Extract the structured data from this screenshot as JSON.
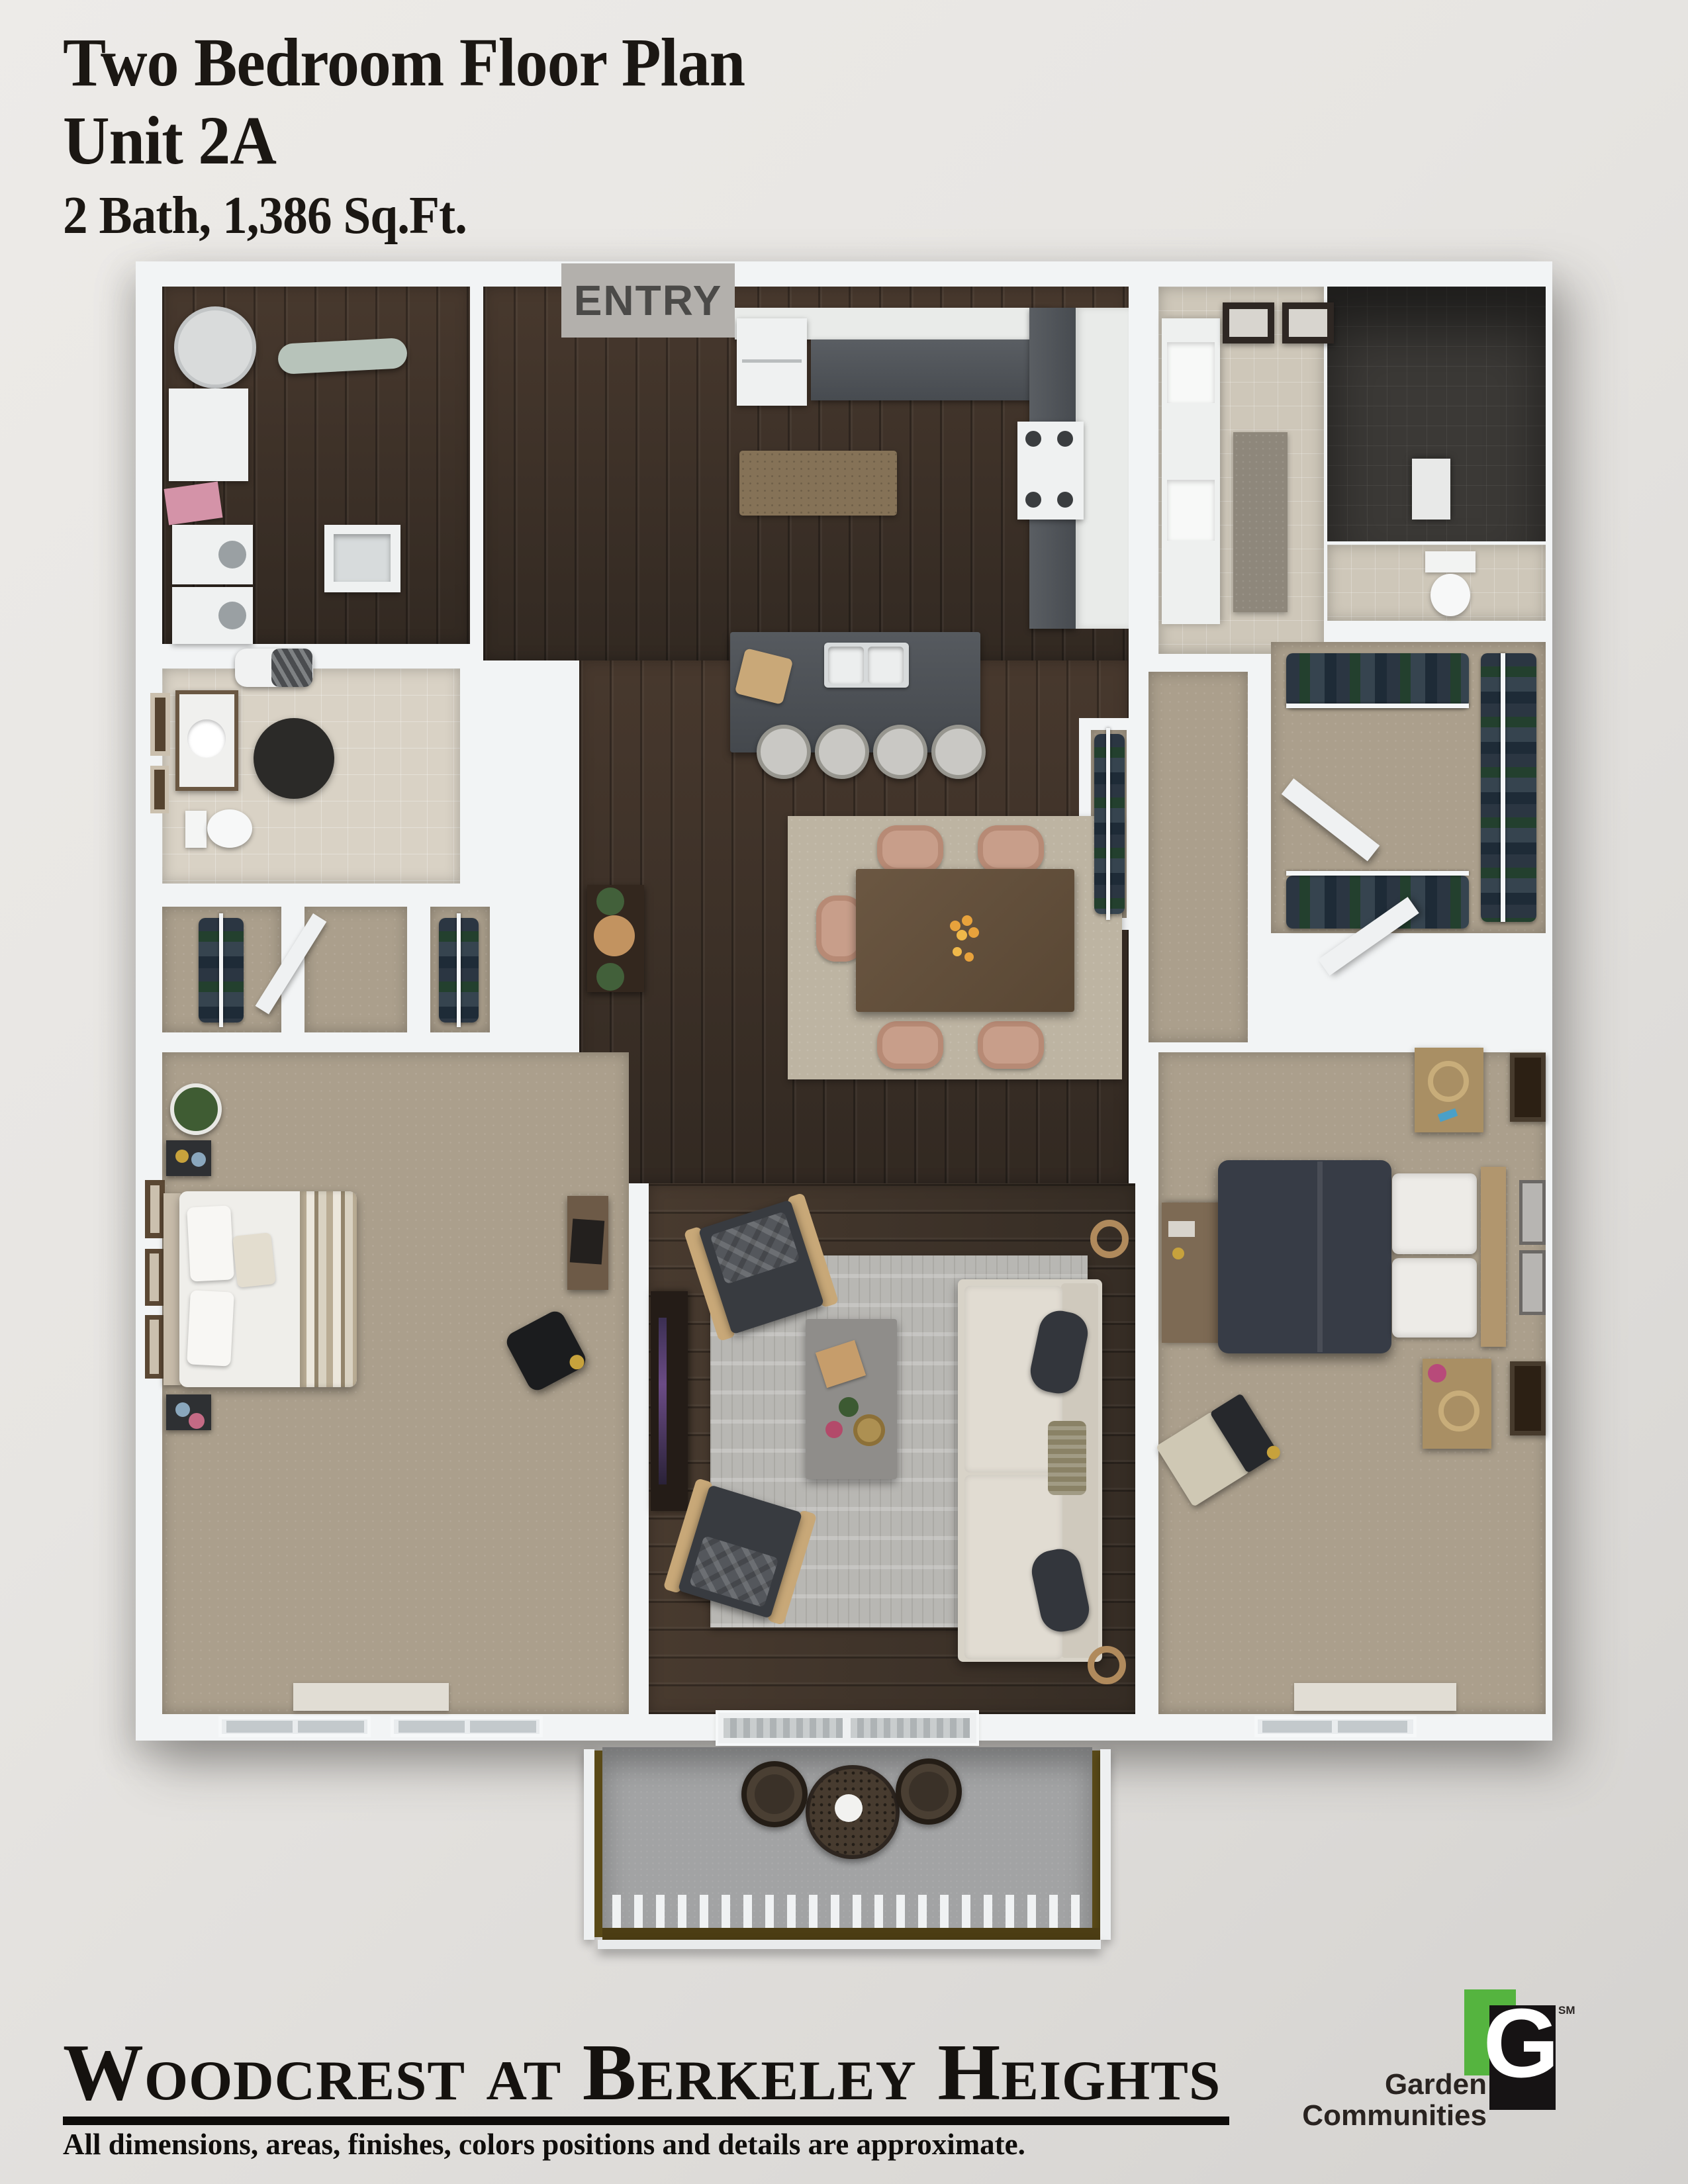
{
  "page": {
    "background_top": "#edebe8",
    "background_bottom": "#d4d2cf"
  },
  "header": {
    "title_line1": "Two Bedroom Floor Plan",
    "title_line2": "Unit 2A",
    "title_line3": "2 Bath, 1,386 Sq.Ft."
  },
  "floor_plan": {
    "entry_label": "ENTRY",
    "palette": {
      "wall_white": "#f2f4f5",
      "wood_floor": "#3f352c",
      "carpet": "#ab9f8c",
      "bath_tile": "#d9d2c5",
      "master_bath_tile": "#cec7b9",
      "shower_tile": "#3b3936",
      "counter_gray": "#50545a",
      "patio_concrete": "#a2a3a4",
      "living_rug": "#b8b7b3",
      "dining_rug": "#bdb4a2",
      "kitchen_rug": "#857257",
      "accent_pink": "#d493a8"
    }
  },
  "footer": {
    "community_name": "Woodcrest at Berkeley Heights",
    "disclaimer": "All dimensions, areas, finishes, colors positions and details are approximate.",
    "logo": {
      "word1": "Garden",
      "word2": "Communities",
      "monogram": "G",
      "service_mark": "SM",
      "green": "#55b43f",
      "black": "#161314"
    }
  }
}
